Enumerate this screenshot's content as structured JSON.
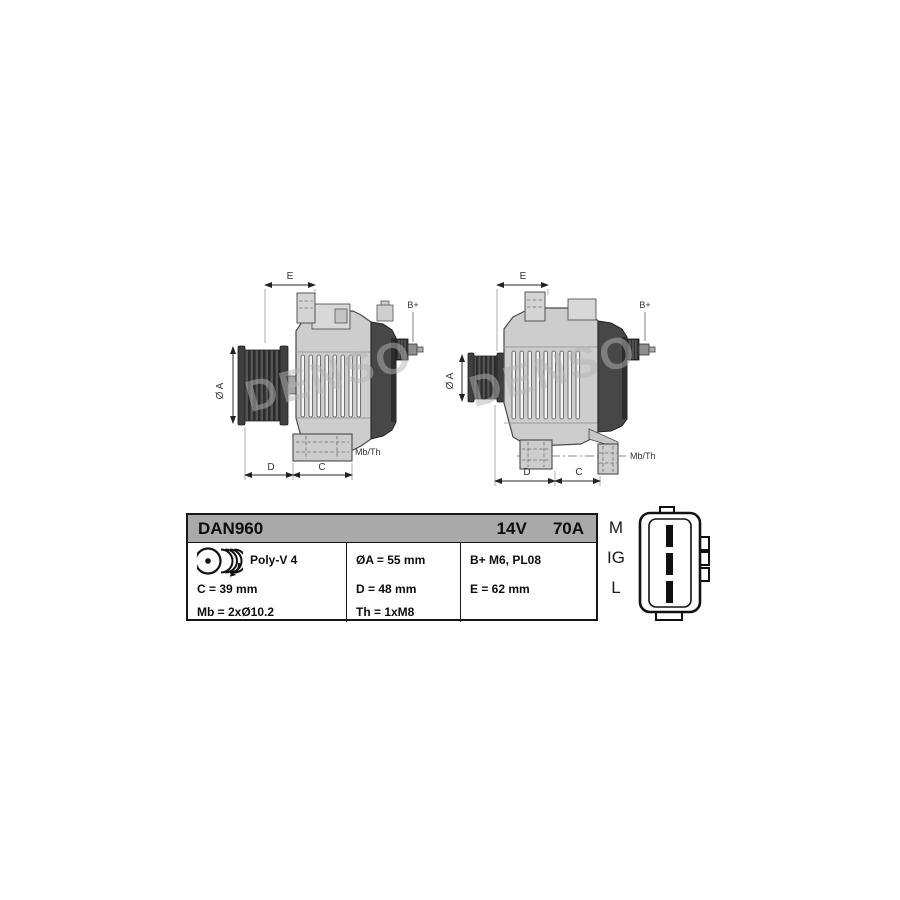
{
  "brand_watermark": "DENSO",
  "drawing_labels": {
    "dim_e": "E",
    "dim_d": "D",
    "dim_c": "C",
    "dim_diameter_a": "Ø A",
    "terminal_bplus": "B+",
    "mount_thread": "Mb/Th"
  },
  "spec_table": {
    "model": "DAN960",
    "voltage": "14V",
    "current": "70A",
    "pulley_label": "Poly-V 4",
    "dim_c": "C = 39 mm",
    "mount_bolts": "Mb = 2xØ10.2",
    "dim_diameter_a": "ØA = 55 mm",
    "dim_d": "D = 48 mm",
    "thread": "Th = 1xM8",
    "terminal": "B+ M6, PL08",
    "dim_e": "E = 62 mm"
  },
  "connector": {
    "pin_labels": [
      "M",
      "IG",
      "L"
    ]
  },
  "colors": {
    "table_header_bg": "#a9a9a9",
    "drawing_body_fill": "#cdcdcd",
    "drawing_dark_fill": "#474747",
    "watermark_gray": "#b5b5b5",
    "line_black": "#161616"
  }
}
